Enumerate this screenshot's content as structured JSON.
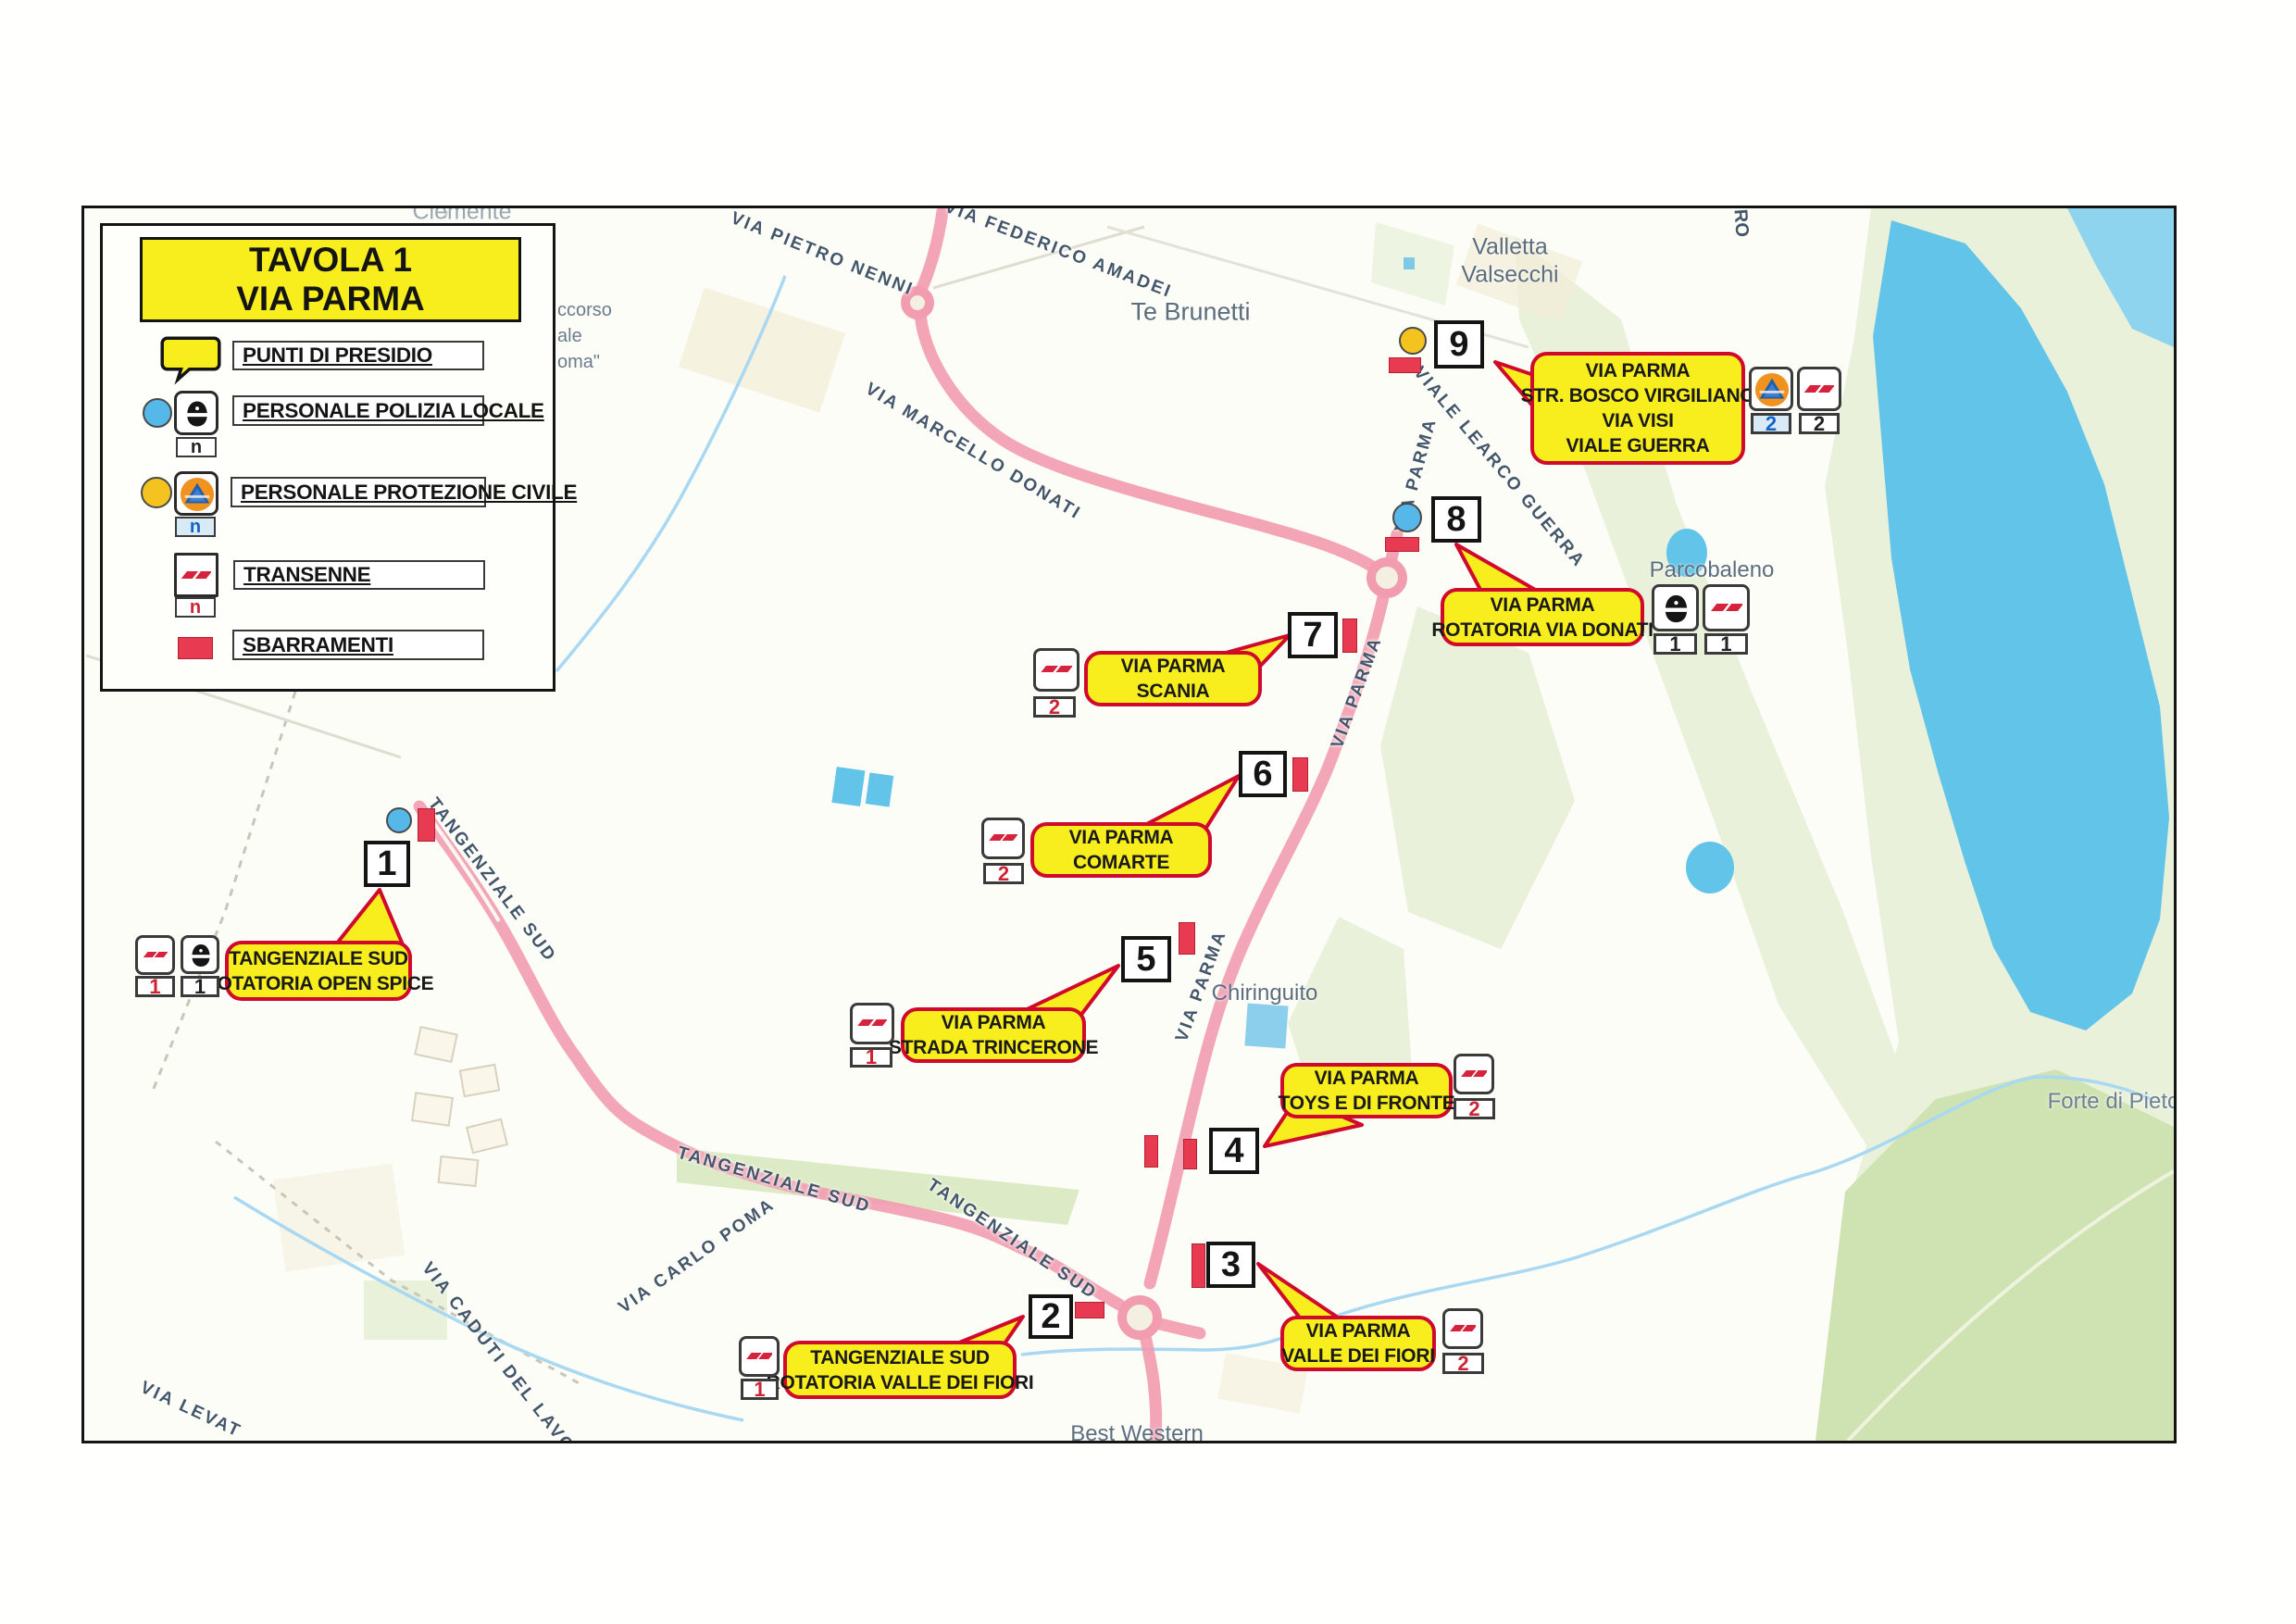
{
  "title": {
    "line1": "TAVOLA 1",
    "line2": "VIA PARMA"
  },
  "legend": {
    "punti": "PUNTI DI PRESIDIO",
    "polizia": "PERSONALE POLIZIA LOCALE",
    "protezione": "PERSONALE PROTEZIONE CIVILE",
    "transenne": "TRANSENNE",
    "sbarramenti": "SBARRAMENTI",
    "count_placeholder": "n"
  },
  "points": [
    {
      "number": "1",
      "callout": [
        "TANGENZIALE SUD",
        "ROTATORIA OPEN SPICE"
      ],
      "units": {
        "transenne": "1",
        "polizia": "1"
      }
    },
    {
      "number": "2",
      "callout": [
        "TANGENZIALE SUD",
        "ROTATORIA VALLE DEI FIORI"
      ],
      "units": {
        "transenne": "1"
      }
    },
    {
      "number": "3",
      "callout": [
        "VIA PARMA",
        "VALLE DEI FIORI"
      ],
      "units": {
        "transenne": "2"
      }
    },
    {
      "number": "4",
      "callout": [
        "VIA PARMA",
        "TOYS E DI FRONTE"
      ],
      "units": {
        "transenne": "2"
      }
    },
    {
      "number": "5",
      "callout": [
        "VIA PARMA",
        "STRADA TRINCERONE"
      ],
      "units": {
        "transenne": "1"
      }
    },
    {
      "number": "6",
      "callout": [
        "VIA PARMA",
        "COMARTE"
      ],
      "units": {
        "transenne": "2"
      }
    },
    {
      "number": "7",
      "callout": [
        "VIA PARMA",
        "SCANIA"
      ],
      "units": {
        "transenne": "2"
      }
    },
    {
      "number": "8",
      "callout": [
        "VIA PARMA",
        "ROTATORIA VIA DONATI"
      ],
      "units": {
        "polizia": "1",
        "transenne": "1"
      }
    },
    {
      "number": "9",
      "callout": [
        "VIA PARMA",
        "STR. BOSCO VIRGILIANO",
        "VIA VISI",
        "VIALE GUERRA"
      ],
      "units": {
        "protezione": "2",
        "transenne": "2"
      }
    }
  ],
  "places": {
    "te_brunetti": "Te Brunetti",
    "valletta_1": "Valletta",
    "valletta_2": "Valsecchi",
    "parcobaleno": "Parcobaleno",
    "chiringuito": "Chiringuito",
    "forte": "Forte di Pieto",
    "best_western": "Best Western",
    "clemente": "Clemente",
    "partial_1": "ccorso",
    "partial_2": "ale",
    "partial_3": "oma\"",
    "partial_ro": "RO"
  },
  "streets": {
    "pietro_nenni": "VIA PIETRO NENNI",
    "federico_amadei": "VIA FEDERICO AMADEI",
    "marcello_donati": "VIA MARCELLO DONATI",
    "learco_guerra": "VIALE LEARCO GUERRA",
    "parma_n": "VIA PARMA",
    "parma_mid": "VIA PARMA",
    "parma_s": "VIA PARMA",
    "tang_1": "TANGENZIALE SUD",
    "tang_2": "TANGENZIALE SUD",
    "tang_3": "TANGENZIALE SUD",
    "carlo_poma": "VIA CARLO POMA",
    "caduti": "VIA CADUTI DEL LAVORO",
    "levata": "VIA LEVAT",
    "amadei_partial": "ADEI"
  },
  "colors": {
    "callout_fill": "#f8ee1e",
    "callout_border": "#cf0a2c",
    "road_highlight": "#f29cb0",
    "water": "#62c4e8",
    "barrier_red": "#e83a50",
    "police_blue": "#55b8e8",
    "civil_yellow": "#f5c320"
  }
}
